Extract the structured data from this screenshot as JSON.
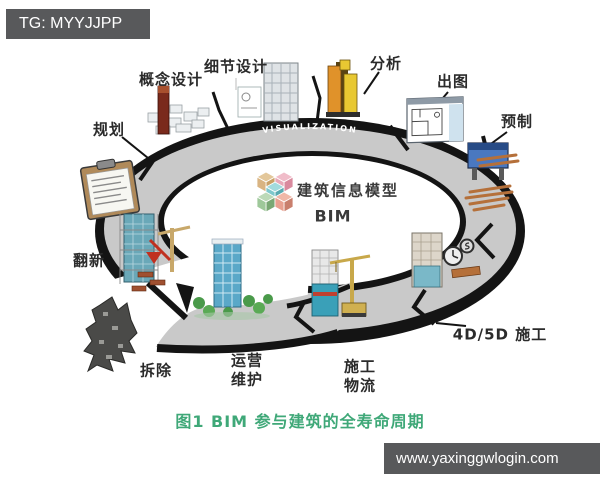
{
  "watermarks": {
    "top_left": "TG: MYYJJPP",
    "bottom_right": "www.yaxinggwlogin.com"
  },
  "diagram": {
    "ring_text": "VISUALIZATION",
    "center": {
      "logo_icon": "bim-cubes-logo",
      "title": "建筑信息模型",
      "subtitle": "BIM"
    },
    "stages": [
      {
        "id": "planning",
        "label": "规划",
        "icon": "city-blocks-icon"
      },
      {
        "id": "concept-design",
        "label": "概念设计",
        "icon": "red-tower-model-icon"
      },
      {
        "id": "detail-design",
        "label": "细节设计",
        "icon": "highrise-model-icon"
      },
      {
        "id": "analysis",
        "label": "分析",
        "icon": "orange-buildings-icon"
      },
      {
        "id": "drawings-output",
        "label": "出图",
        "icon": "floorplan-window-icon"
      },
      {
        "id": "prefabrication",
        "label": "预制",
        "icon": "pipe-machine-icon"
      },
      {
        "id": "4d5d-construction",
        "label": "4D/5D 施工",
        "icon": "construction-clock-icon"
      },
      {
        "id": "construction-logistics",
        "label": "施工\n物流",
        "icon": "tower-crane-site-icon"
      },
      {
        "id": "operation-maintenance",
        "label": "运营\n维护",
        "icon": "office-tower-trees-icon"
      },
      {
        "id": "demolition",
        "label": "拆除",
        "icon": "rubble-building-icon"
      },
      {
        "id": "renovation",
        "label": "翻新",
        "icon": "scaffold-crane-icon"
      }
    ],
    "caption": "图1 BIM 参与建筑的全寿命周期"
  },
  "colors": {
    "banner_bg": "#58595b",
    "caption_green": "#3fa878",
    "ring_gray": "#c9c9c9",
    "ring_rim": "#141414",
    "cube_palette": [
      "#d9b482",
      "#e8a8b8",
      "#7ec8cc",
      "#e8a090",
      "#9ec89a"
    ]
  }
}
